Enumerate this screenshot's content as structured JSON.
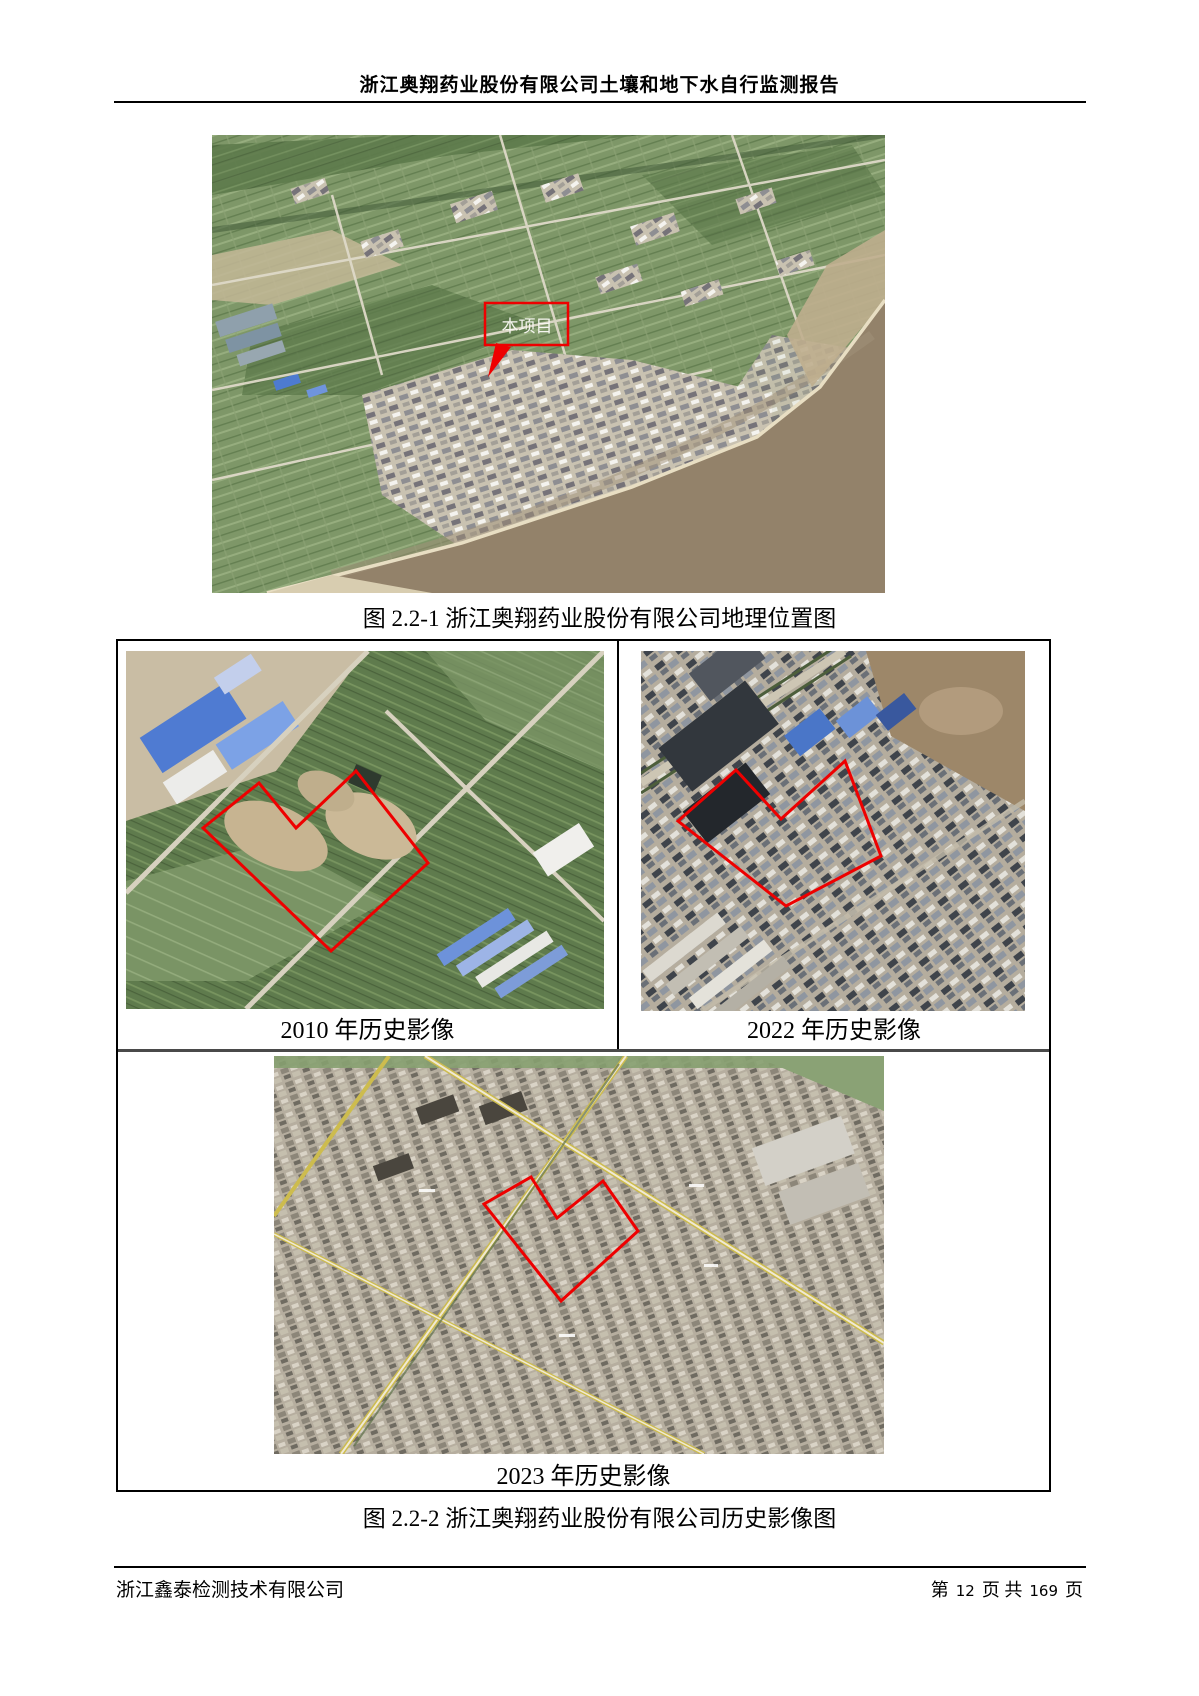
{
  "header": {
    "title": "浙江奥翔药业股份有限公司土壤和地下水自行监测报告"
  },
  "figure1": {
    "caption": "图 2.2-1 浙江奥翔药业股份有限公司地理位置图",
    "map": {
      "callout_label": "本项目",
      "boundary_color": "#ee0000"
    }
  },
  "figure2": {
    "caption": "图 2.2-2 浙江奥翔药业股份有限公司历史影像图",
    "boundary_color": "#ee0000",
    "panels": [
      {
        "label": "2010 年历史影像"
      },
      {
        "label": "2022 年历史影像"
      },
      {
        "label": "2023 年历史影像"
      }
    ]
  },
  "footer": {
    "company": "浙江鑫泰检测技术有限公司",
    "page": {
      "prefix": "第",
      "current": "12",
      "middle": "页 共",
      "total": "169",
      "suffix": "页"
    }
  }
}
